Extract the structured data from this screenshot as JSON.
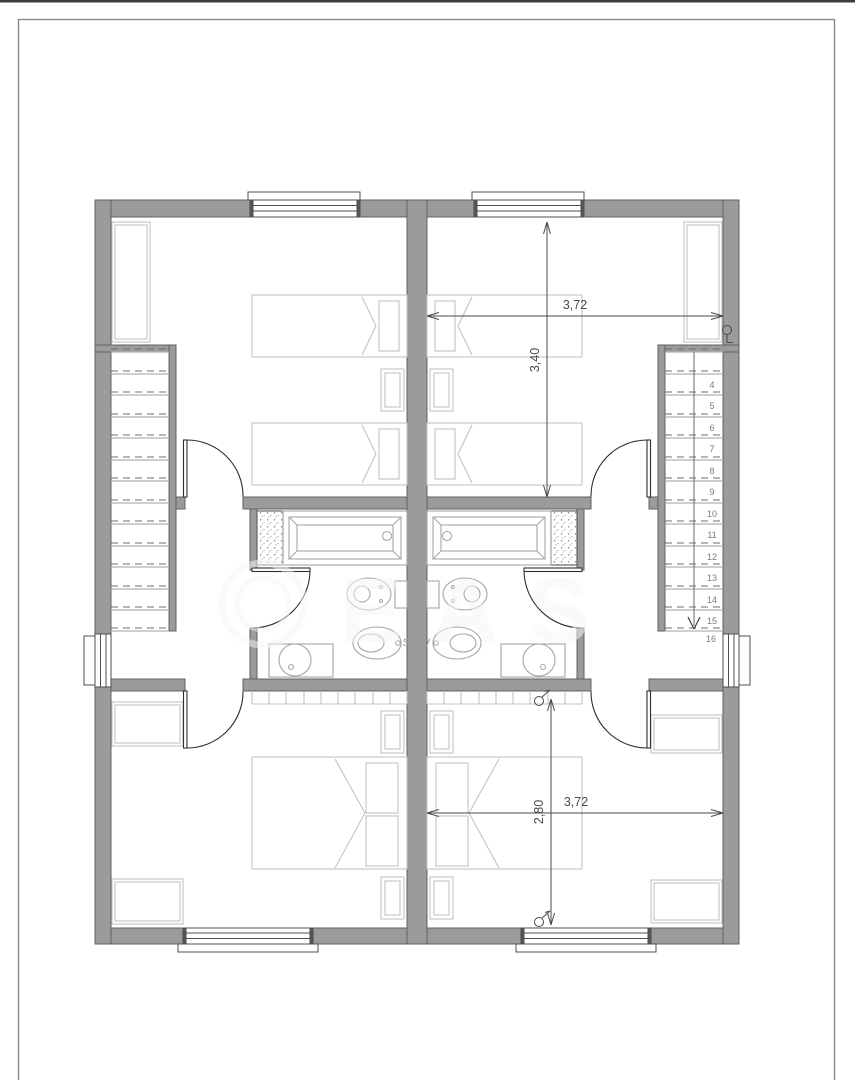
{
  "drawing": {
    "type": "architectural floor plan - mirrored duplex upper storey",
    "dimension_labels": {
      "upper_bedroom_width": "3,72",
      "upper_bedroom_depth": "3,40",
      "lower_bedroom_width": "3,72",
      "lower_bedroom_depth": "2,80"
    },
    "stair_right": {
      "tread_numbers": [
        "4",
        "5",
        "6",
        "7",
        "8",
        "9",
        "10",
        "11",
        "12",
        "13",
        "14",
        "15"
      ],
      "landing_number": "16"
    },
    "watermark": {
      "large_text": "EAS",
      "small_text": "S V"
    },
    "colors": {
      "top_edge": "#3c3c3c",
      "page_border": "#8a8a8a",
      "wall_fill": "#9b9b9b",
      "wall_edge": "#616161",
      "window_line": "#4f4f4f",
      "furniture": "#c3c3c3",
      "fixture": "#a6a6a6",
      "stair_solid": "#b0b0b0",
      "stair_dash": "#6e6e6e",
      "stair_number": "#7a7a7a",
      "door": "#2f2f2f",
      "dimension": "#4a4a4a"
    }
  }
}
